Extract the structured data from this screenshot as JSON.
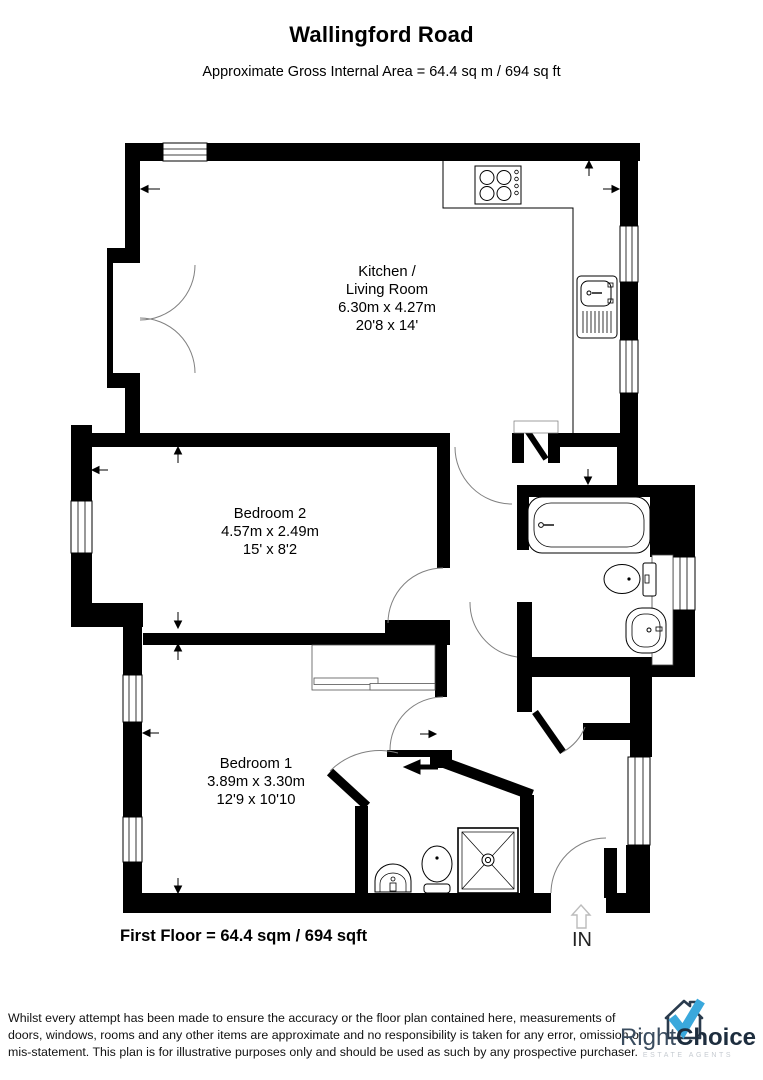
{
  "header": {
    "title": "Wallingford Road",
    "subtitle": "Approximate Gross Internal Area = 64.4 sq m / 694 sq ft"
  },
  "rooms": {
    "kitchen_living": {
      "line1": "Kitchen /",
      "line2": "Living Room",
      "metric": "6.30m x 4.27m",
      "imperial": "20'8 x 14'"
    },
    "bedroom2": {
      "name": "Bedroom 2",
      "metric": "4.57m x 2.49m",
      "imperial": "15' x 8'2"
    },
    "bedroom1": {
      "name": "Bedroom 1",
      "metric": "3.89m x 3.30m",
      "imperial": "12'9 x 10'10"
    }
  },
  "footer": {
    "floor_summary": "First Floor = 64.4 sqm / 694 sqft",
    "entrance_label": "IN",
    "disclaimer_lines": [
      "Whilst every attempt has been made to ensure the accuracy or the floor plan contained here, measurements of",
      "doors, windows, rooms and any other items are approximate and no responsibility is taken for any error, omission or",
      "mis-statement. This plan is for illustrative purposes only and should be used as such by any prospective purchaser."
    ]
  },
  "logo": {
    "brand_part1": "Right",
    "brand_part2": "Choice",
    "tagline": "ESTATE AGENTS",
    "check_color": "#3aa8dc",
    "house_color": "#2a3b4d"
  },
  "plan_colors": {
    "wall": "#000000",
    "door_arc": "#808080",
    "entrance_arrow": "#bcbcbc"
  }
}
